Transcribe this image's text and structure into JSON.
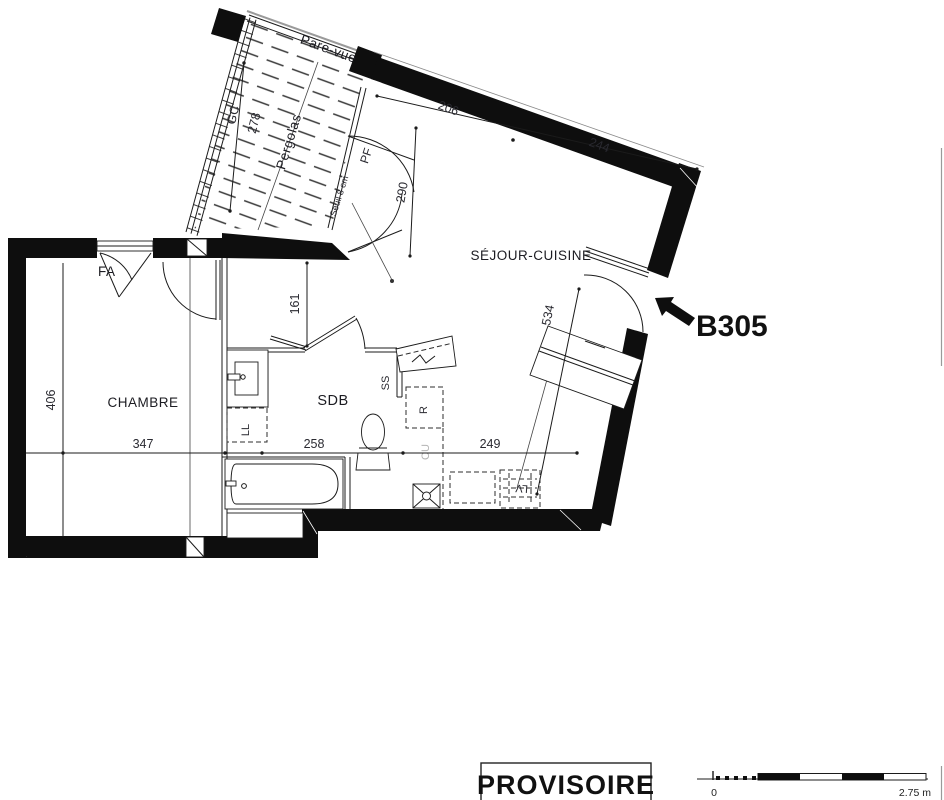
{
  "plan": {
    "unit": {
      "label": "B305"
    },
    "rooms": {
      "sejour": "SÉJOUR-CUISINE",
      "chambre": "CHAMBRE",
      "sdb": "SDB"
    },
    "balcony": {
      "pare_vue": "Pare-vue",
      "pergolas": "Pergolas",
      "gc": "GC"
    },
    "openings": {
      "fa": "FA",
      "pf": "PF",
      "seuil": "Seuil 8 cm"
    },
    "fixtures": {
      "ll": "LL",
      "ss": "SS",
      "r": "R",
      "cu": "CU",
      "lv": "LV"
    },
    "dims": {
      "d206": "206",
      "d244": "244",
      "d278": "278",
      "d290": "290",
      "d161": "161",
      "d406": "406",
      "d347": "347",
      "d258": "258",
      "d249": "249",
      "d534": "534"
    },
    "footer": {
      "stamp": "PROVISOIRE",
      "scale_zero": "0",
      "scale_max": "2.75 m"
    }
  }
}
